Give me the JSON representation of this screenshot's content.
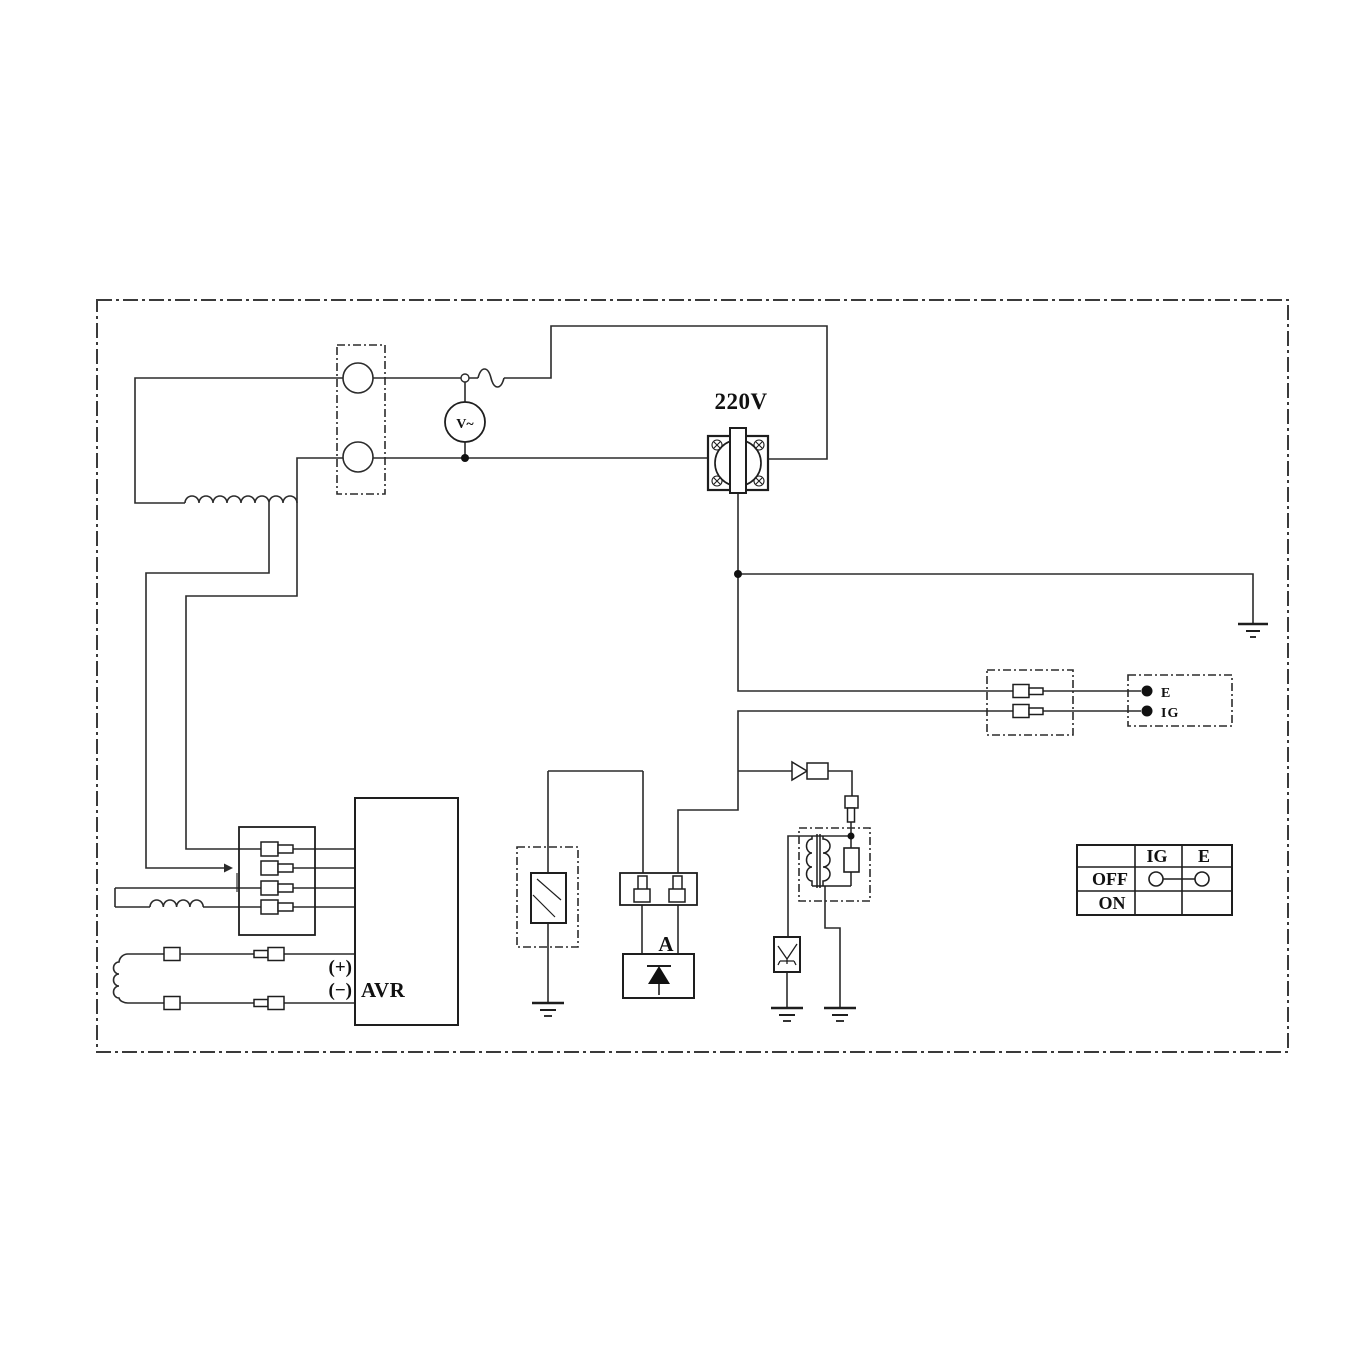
{
  "labels": {
    "outlet_voltage": "220V",
    "voltmeter": "V~",
    "connector_e": "E",
    "connector_ig": "IG",
    "oil_unit": "A",
    "avr": "AVR",
    "avr_plus": "(+)",
    "avr_minus": "(−)"
  },
  "switch_table": {
    "col_ig": "IG",
    "col_e": "E",
    "row_off": "OFF",
    "row_on": "ON"
  },
  "colors": {
    "line": "#2b2b2b",
    "background": "#ffffff"
  }
}
